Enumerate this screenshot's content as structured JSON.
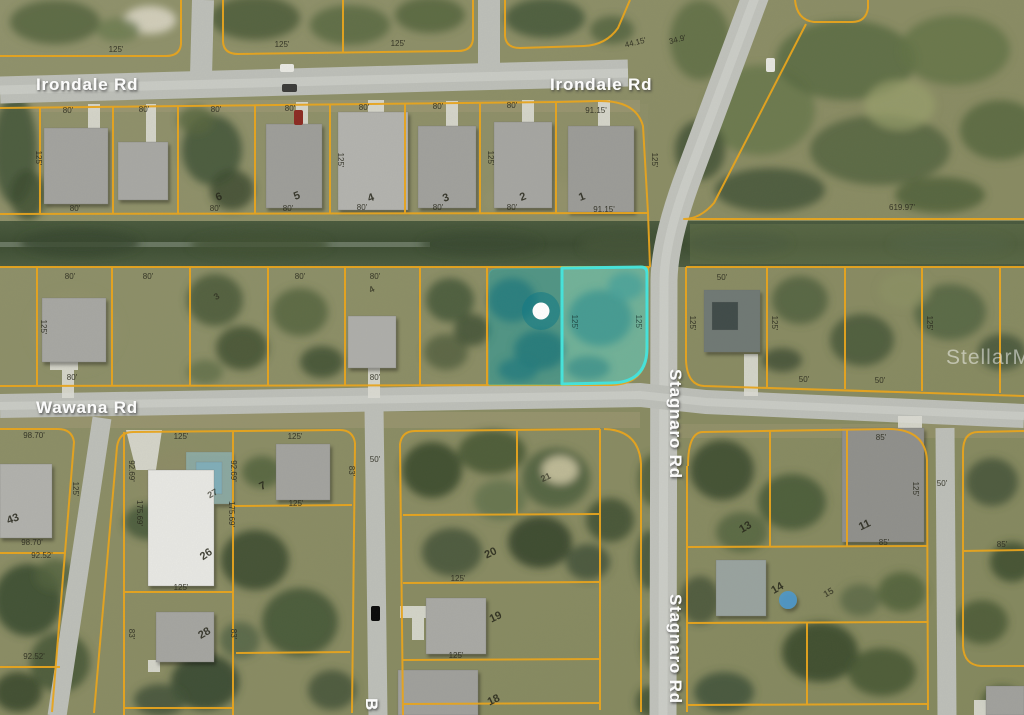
{
  "roads": {
    "irondale_west": "Irondale Rd",
    "irondale_east": "Irondale Rd",
    "wawana": "Wawana Rd",
    "stagnaro_upper": "Stagnaro Rd",
    "stagnaro_lower": "Stagnaro Rd",
    "partial_bottom": "B"
  },
  "watermark": {
    "text": "StellarMLS"
  },
  "dims": {
    "d80": "80'",
    "d125": "125'",
    "d9115": "91.15'",
    "d61997": "619.97'",
    "d4415": "44.15'",
    "d349": "34.9'",
    "d9870": "98.70'",
    "d9252": "92.52'",
    "d17569": "175.69'",
    "d9269": "92.69'",
    "d83": "83'",
    "d50": "50'",
    "d85": "85'"
  },
  "lots": {
    "n1": "1",
    "n2": "2",
    "n3": "3",
    "n4": "4",
    "n5": "5",
    "n6": "6",
    "n7": "7",
    "n11": "11",
    "n13": "13",
    "n14": "14",
    "n15": "15",
    "n18": "18",
    "n19": "19",
    "n20": "20",
    "n21": "21",
    "n26": "26",
    "n27": "27",
    "n28": "28",
    "n43": "43"
  },
  "highlight": {
    "selected_parcels": 2,
    "marker": "white-dot",
    "outline_color": "#40E8E4",
    "fill_color": "#52E6E2"
  },
  "colors": {
    "parcel_line": "#EAA61D",
    "road": "#BDBFB9",
    "canal": "#45543A",
    "terrain": "#8E906A"
  }
}
